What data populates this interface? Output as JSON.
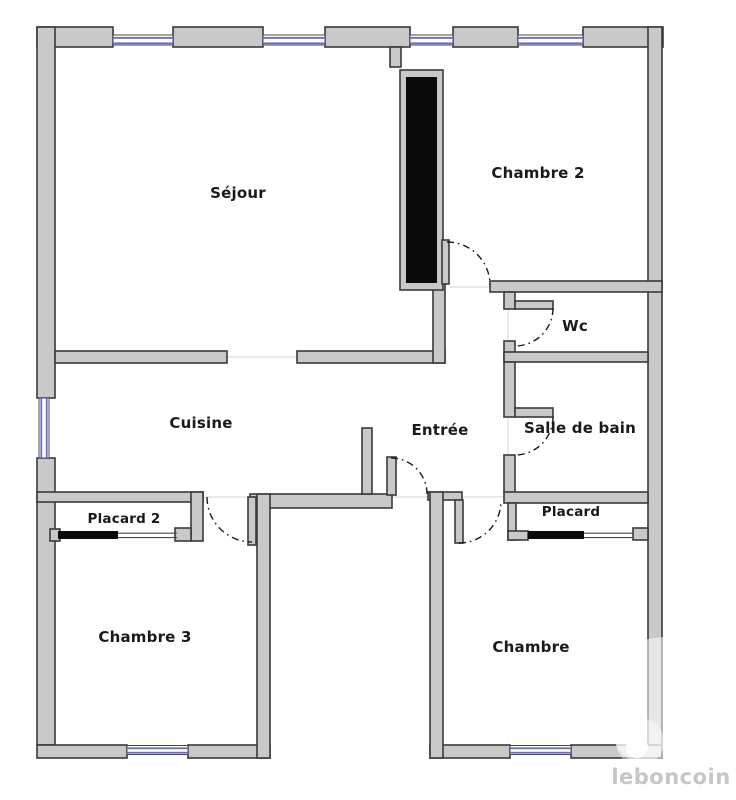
{
  "document": {
    "kind": "apartment-floor-plan"
  },
  "rooms": {
    "sejour": "Séjour",
    "chambre2": "Chambre 2",
    "wc": "Wc",
    "cuisine": "Cuisine",
    "entree": "Entrée",
    "salle_de_bain": "Salle de bain",
    "placard2": "Placard 2",
    "placard": "Placard",
    "chambre3": "Chambre 3",
    "chambre": "Chambre"
  },
  "watermark": {
    "brand": "leboncoin"
  },
  "colors": {
    "background": "#ffffff",
    "wall_fill": "#c9c9c9",
    "wall_outline": "#3a3a3a",
    "window_blue": "#6a6ace",
    "feature_black": "#0a0a0a",
    "label_text": "#1a1a1a",
    "watermark_text": "#c6c6c6"
  }
}
